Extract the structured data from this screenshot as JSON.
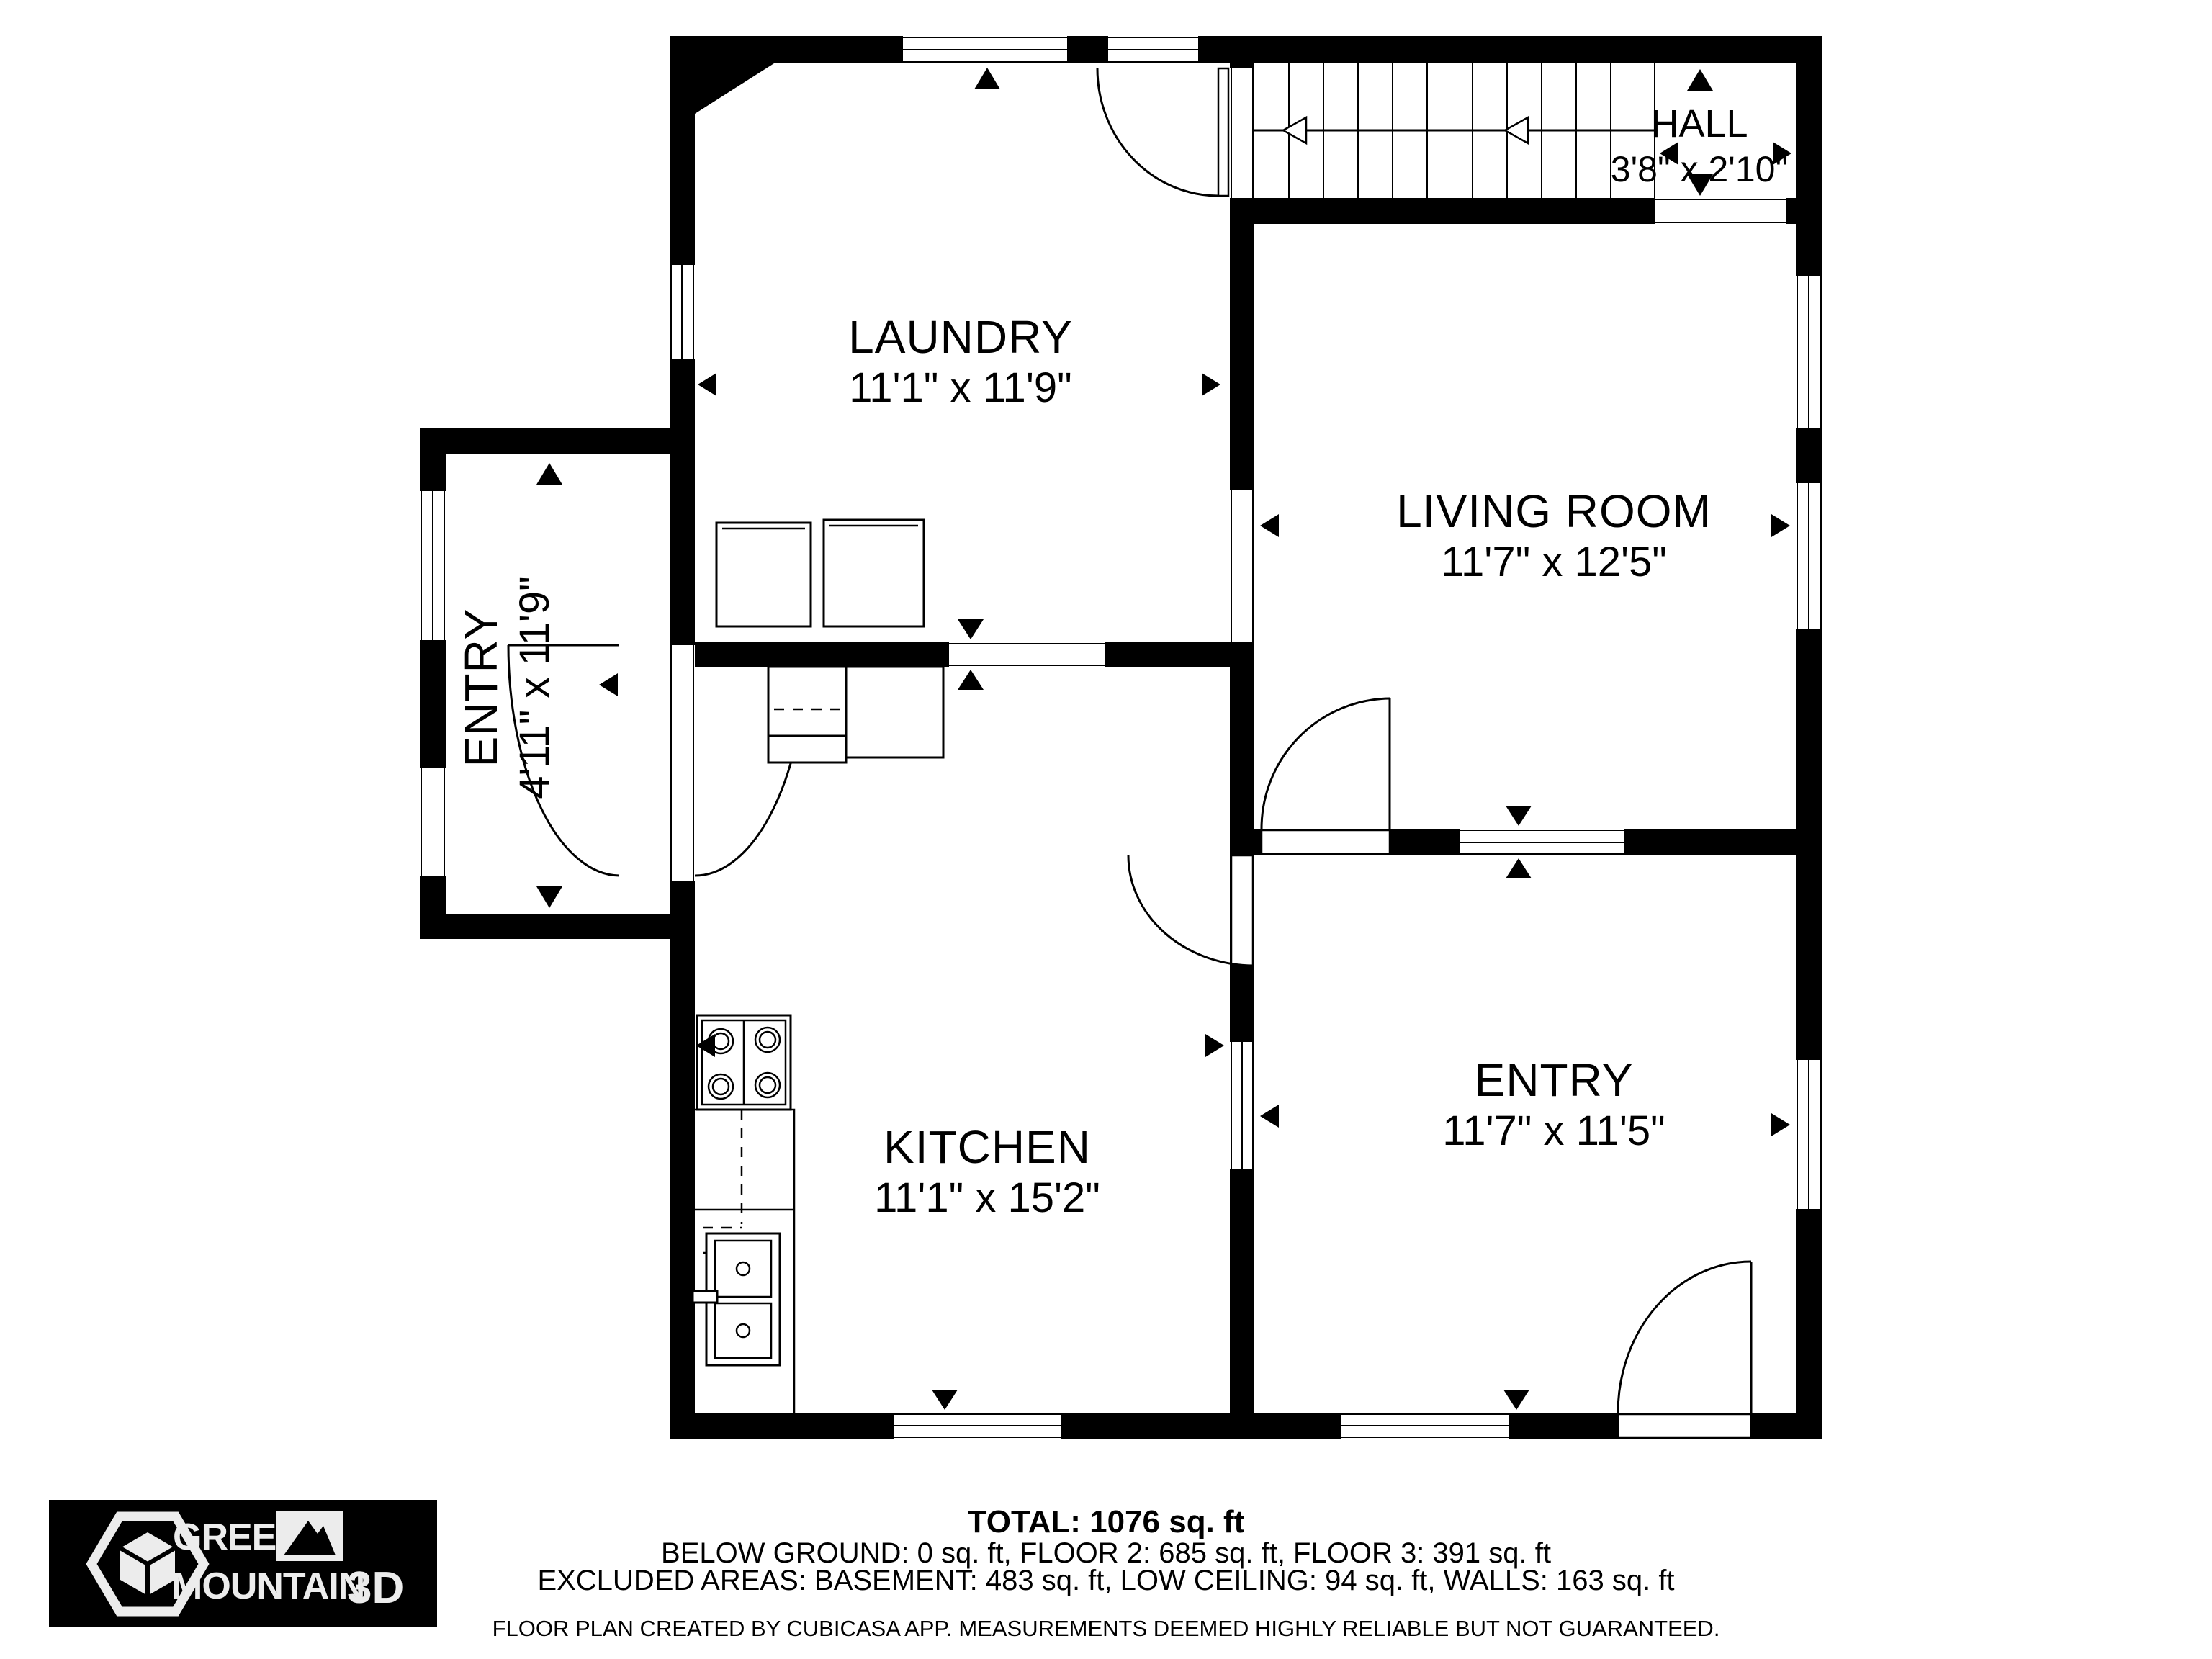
{
  "rooms": {
    "laundry": {
      "name": "LAUNDRY",
      "dims": "11'1\" x 11'9\""
    },
    "living": {
      "name": "LIVING ROOM",
      "dims": "11'7\" x 12'5\""
    },
    "kitchen": {
      "name": "KITCHEN",
      "dims": "11'1\" x 15'2\""
    },
    "entry_main": {
      "name": "ENTRY",
      "dims": "11'7\" x 11'5\""
    },
    "entry_porch": {
      "name": "ENTRY",
      "dims": "4'11\" x 11'9\""
    },
    "hall": {
      "name": "HALL",
      "dims": "3'8\" x 2'10\""
    }
  },
  "summary": {
    "total": "TOTAL: 1076 sq. ft",
    "floors": "BELOW GROUND: 0 sq. ft, FLOOR 2: 685 sq. ft, FLOOR 3: 391 sq. ft",
    "excluded": "EXCLUDED AREAS: BASEMENT: 483 sq. ft, LOW CEILING: 94 sq. ft, WALLS: 163 sq. ft",
    "disclaimer": "FLOOR PLAN CREATED BY CUBICASA APP. MEASUREMENTS DEEMED HIGHLY RELIABLE BUT NOT GUARANTEED."
  },
  "logo": {
    "word1": "GREEN",
    "word2": "MOUNTAIN",
    "suffix": "3D"
  },
  "colors": {
    "wall": "#000000",
    "floor": "#ffffff",
    "logo_background": "#000000",
    "logo_foreground": "#ececec"
  }
}
